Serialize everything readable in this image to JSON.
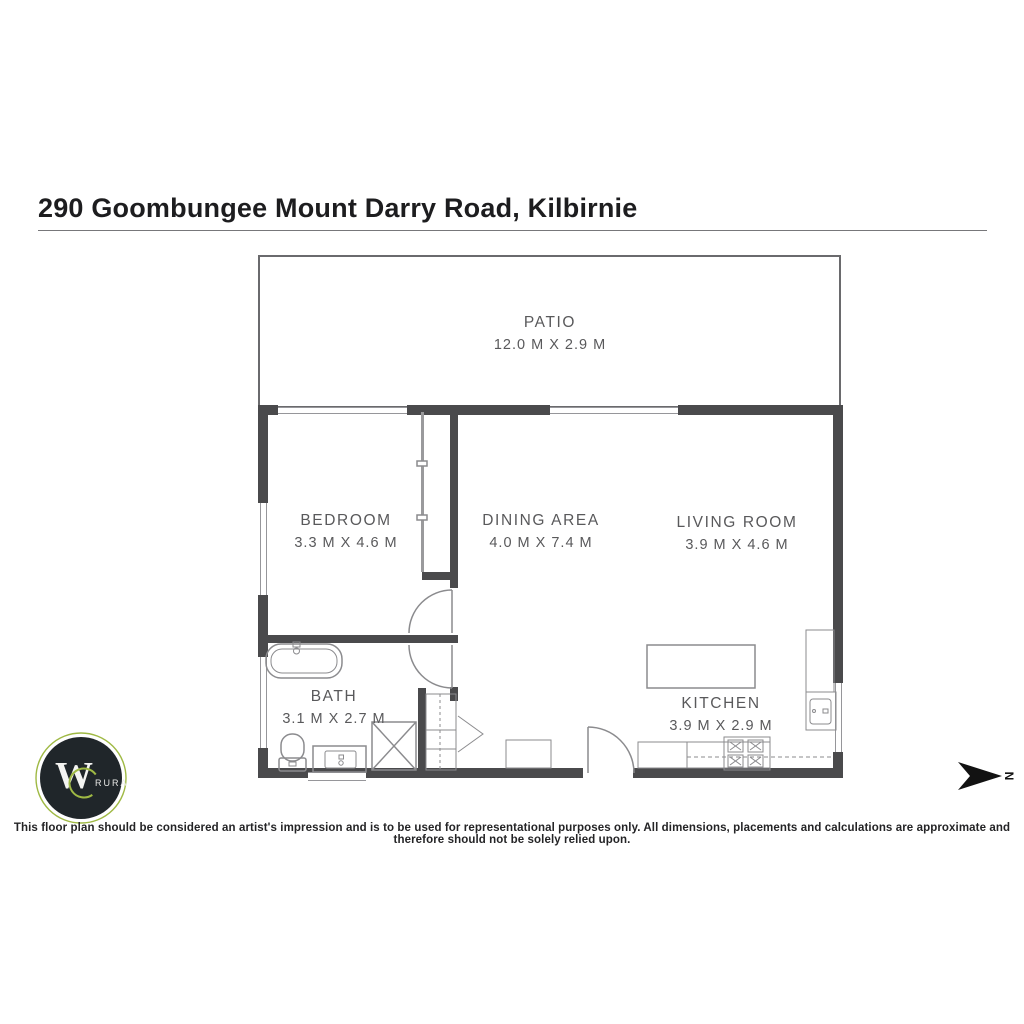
{
  "page": {
    "title": "290 Goombungee Mount Darry Road, Kilbirnie"
  },
  "rooms": [
    {
      "id": "patio",
      "label": "PATIO",
      "dims": "12.0 M X 2.9 M"
    },
    {
      "id": "bedroom",
      "label": "BEDROOM",
      "dims": "3.3 M X 4.6 M"
    },
    {
      "id": "dining",
      "label": "DINING AREA",
      "dims": "4.0 M X 7.4 M"
    },
    {
      "id": "living",
      "label": "LIVING ROOM",
      "dims": "3.9 M X 4.6 M"
    },
    {
      "id": "bath",
      "label": "BATH",
      "dims": "3.1 M X 2.7 M"
    },
    {
      "id": "kitchen",
      "label": "KITCHEN",
      "dims": "3.9 M X 2.9 M"
    }
  ],
  "compass": {
    "label": "N"
  },
  "logo": {
    "letter": "W",
    "text": "RURAL"
  },
  "footer": {
    "disclaimer": "This floor plan should be considered an artist's impression and is to be used for representational purposes only. All dimensions, placements and calculations are approximate and therefore should not be solely relied upon."
  },
  "colors": {
    "wall": "#4a4a4c",
    "fixture_stroke": "#8b8b8e",
    "label_text": "#59595b",
    "logo_ring_green": "#9fb944",
    "logo_circle": "#20262a"
  }
}
